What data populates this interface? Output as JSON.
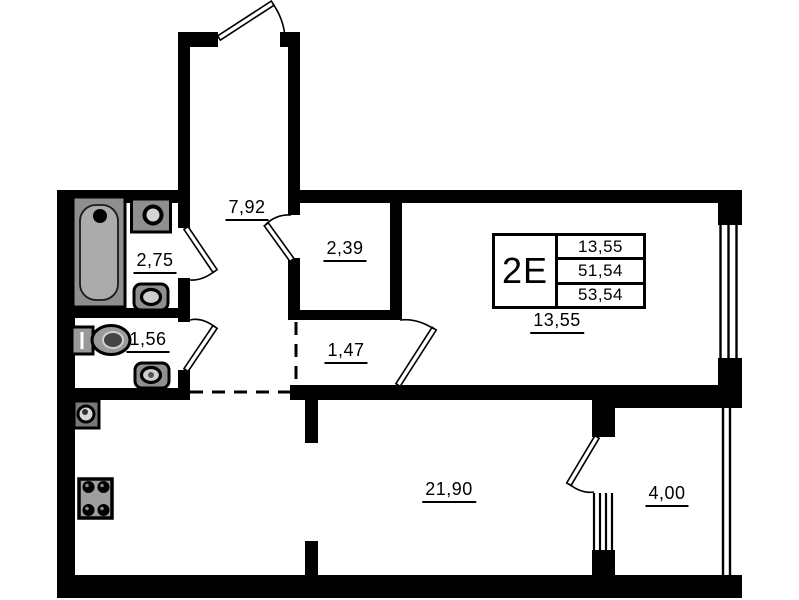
{
  "plan": {
    "unit": {
      "type": "2E",
      "values": [
        "13,55",
        "51,54",
        "53,54"
      ]
    },
    "areas": {
      "hall_upper": "7,92",
      "closet": "2,39",
      "bathroom": "2,75",
      "wc": "1,56",
      "hall_lower": "1,47",
      "room": "13,55",
      "kitchen_living": "21,90",
      "balcony": "4,00"
    },
    "colors": {
      "wall": "#000000",
      "fixture": "#8f8f8f",
      "fixture_light": "#d6d6d6",
      "background": "#ffffff"
    }
  }
}
